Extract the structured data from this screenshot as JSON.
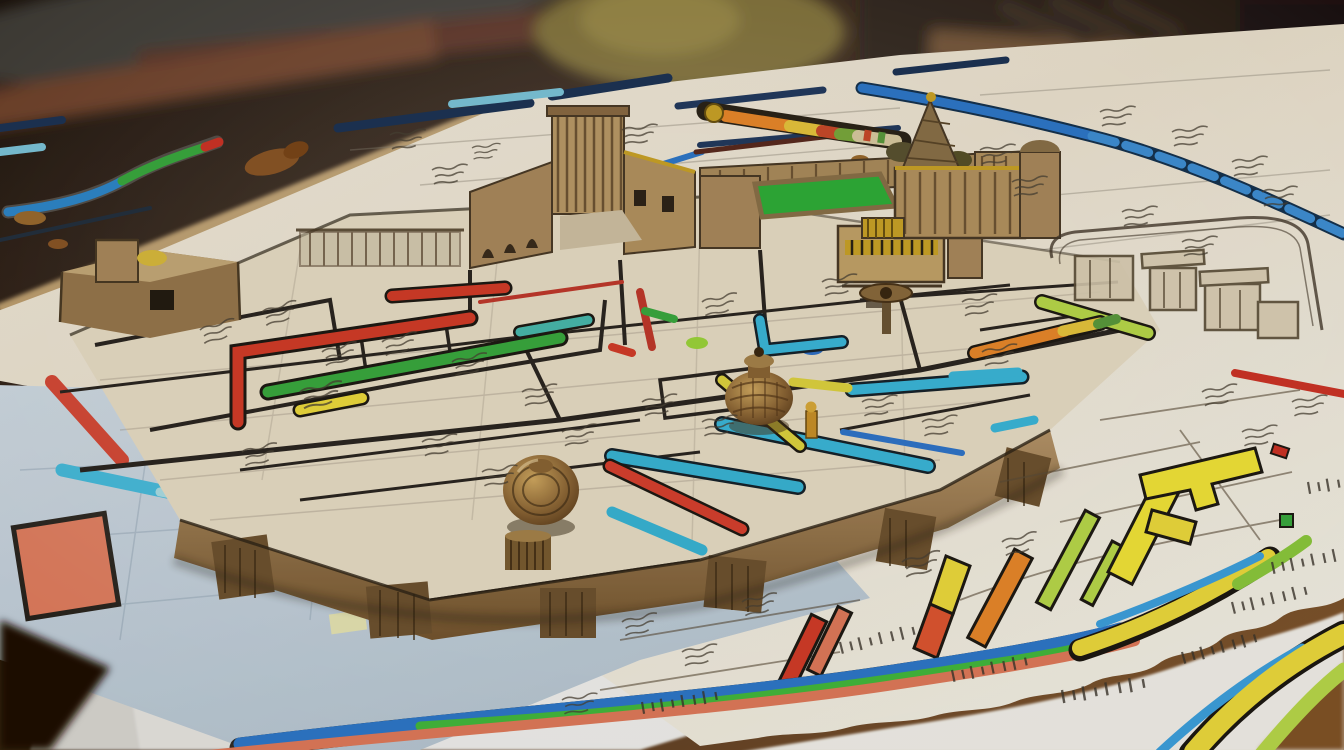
{
  "scene": {
    "description": "Hand-drawn antique city blueprint spread over a dark wooden desk; a raised map board carries miniature carved buildings, bronze knobs and brightly highlighted routes; torn paper sheets fan out at the edges",
    "background": "blurred desk with pens, rulers and carved boxes along the top edge",
    "style": "sepia ink floorplan covered in illegible pseudo-text scribbles and highlighter markings"
  },
  "palette": {
    "desk_dark": "#211309",
    "desk_warm": "#7b4f24",
    "paper_cream": "#ece4d4",
    "paper_white": "#f2f0ea",
    "paper_blue": "#c2cfda",
    "board_tan": "#e7dcc4",
    "edge_wood": "#96764a",
    "support_wood": "#6e522f",
    "ink": "#2b2620",
    "sketch": "#5a4c38",
    "route_red": "#d23c28",
    "route_salmon": "#e07a5a",
    "route_orange": "#e8872a",
    "route_yellow": "#ecd93c",
    "route_lime": "#b8d84a",
    "route_green": "#3aa83e",
    "route_teal": "#3bb6d8",
    "route_blue": "#2e77c8",
    "route_navy": "#1d3354",
    "courtyard_green": "#2fae38",
    "gold": "#c9a227",
    "bronze": "#8a6434",
    "splotch_brown": "#8a5526"
  },
  "objects": {
    "buildings": [
      {
        "name": "left-fort",
        "type": "low adobe fort with yellow daub"
      },
      {
        "name": "arch-fortress",
        "type": "arched courtyard fortress with square tower"
      },
      {
        "name": "green-courtyard-compound",
        "type": "walled compound with bright green courtyard"
      },
      {
        "name": "striped-kiosk",
        "type": "pavilion with gold striped band"
      },
      {
        "name": "spire-castle",
        "type": "castle with conical spire and gold finial"
      },
      {
        "name": "stone-ruins",
        "type": "sketched dolmen ruins on rounded map corner"
      }
    ],
    "pieces": [
      {
        "name": "ringed-knob",
        "type": "large brass disc with concentric rings"
      },
      {
        "name": "bronze-pot-knob",
        "type": "round ribbed bronze pot"
      },
      {
        "name": "gold-figurine",
        "type": "tiny gold figure"
      },
      {
        "name": "valve-handle",
        "type": "brass T-handle"
      }
    ],
    "routes": [
      "red",
      "green",
      "yellow",
      "teal",
      "blue",
      "navy",
      "dashed-blue",
      "tricolor-worm",
      "beaded-scale-bar"
    ],
    "highlight_bars": [
      "red",
      "salmon",
      "yellow-red",
      "orange",
      "lime",
      "bright-yellow"
    ],
    "curved_road_bands": [
      "blue",
      "green",
      "salmon",
      "yellow"
    ]
  }
}
